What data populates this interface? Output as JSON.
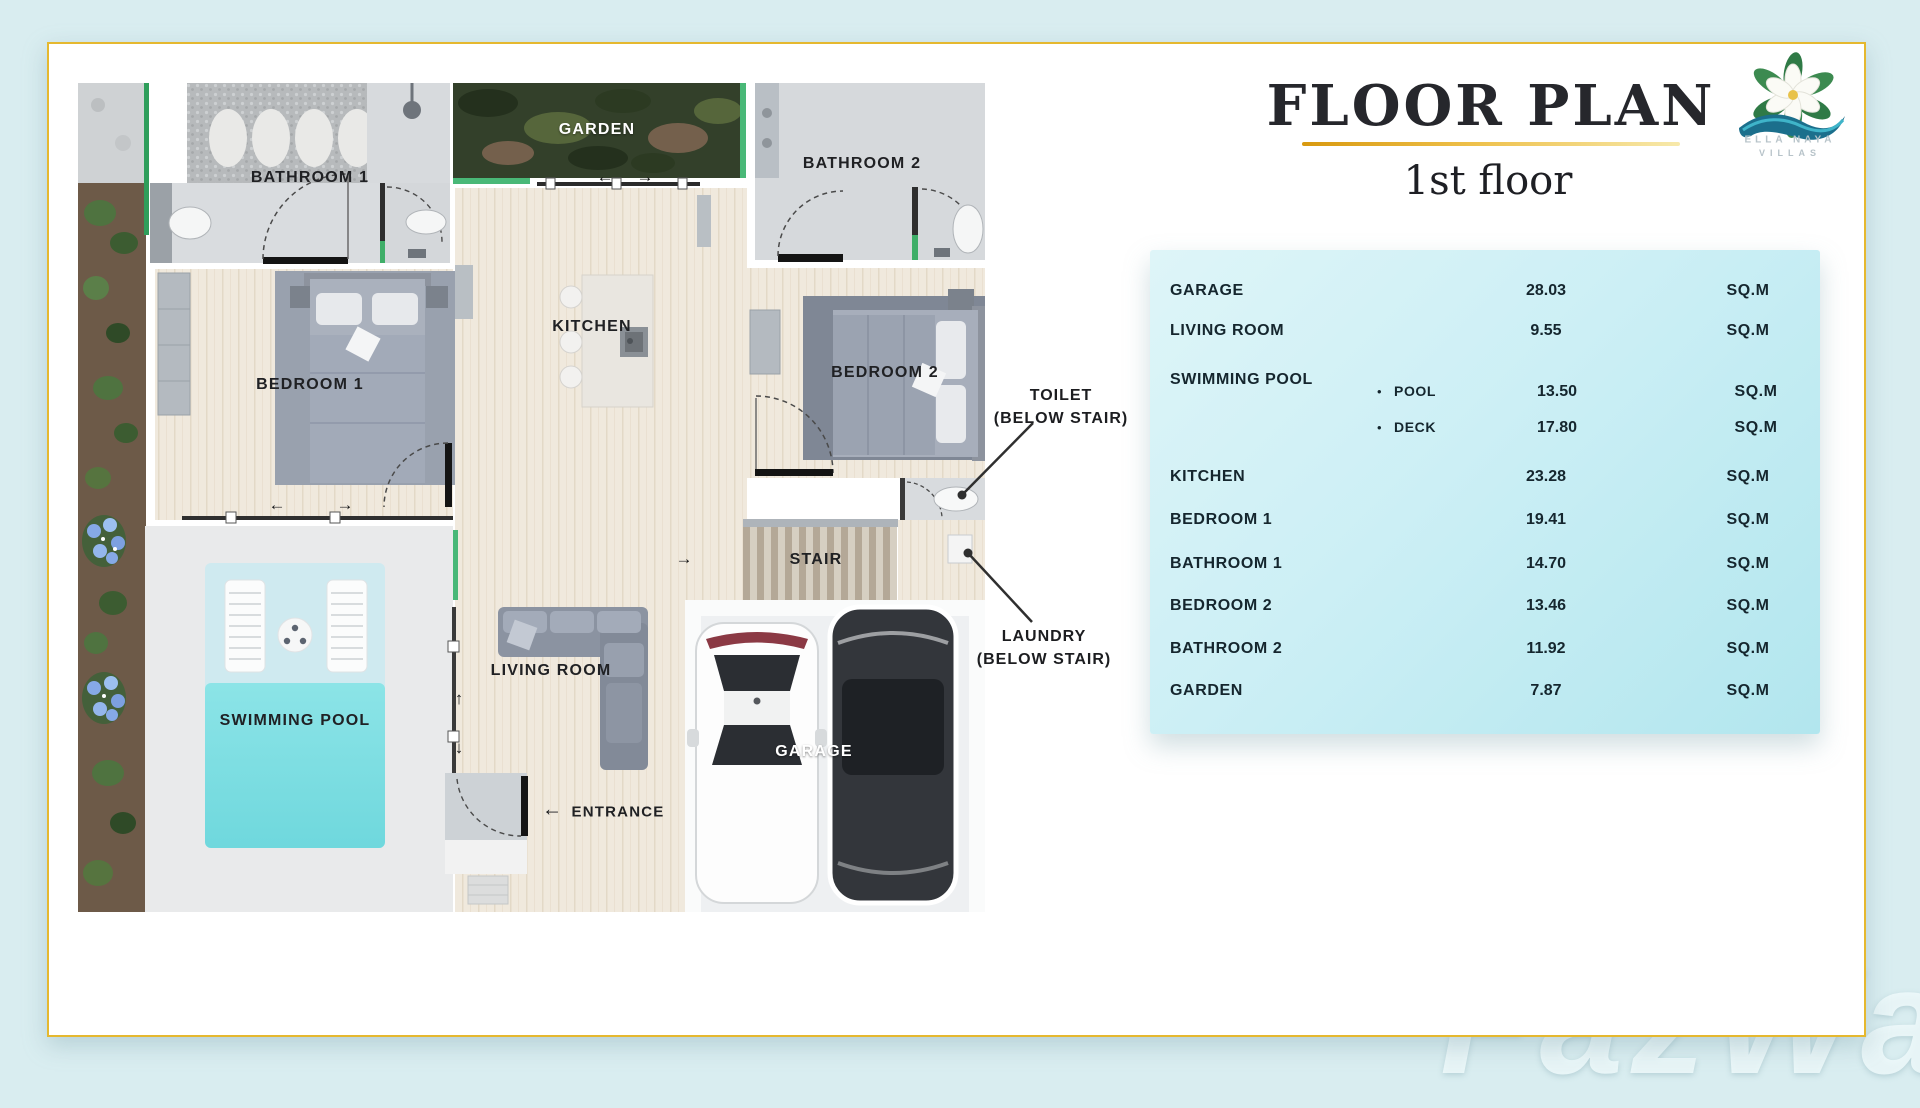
{
  "page": {
    "background": "#d9edf0",
    "watermark": "FazWaz"
  },
  "header": {
    "title": "FLOOR PLAN",
    "subtitle": "1st floor",
    "accent_color": "#E5B82F"
  },
  "logo": {
    "name_line1": "ELLA NAYA",
    "name_line2": "VILLAS"
  },
  "plan": {
    "room_labels": {
      "bathroom1": "BATHROOM 1",
      "garden": "GARDEN",
      "bathroom2": "BATHROOM 2",
      "kitchen": "KITCHEN",
      "bedroom1": "BEDROOM 1",
      "bedroom2": "BEDROOM 2",
      "stair": "STAIR",
      "swimming_pool": "SWIMMING POOL",
      "living_room": "LIVING ROOM",
      "garage": "GARAGE",
      "entrance": "ENTRANCE"
    },
    "annotations": {
      "toilet_line1": "TOILET",
      "toilet_line2": "(BELOW STAIR)",
      "laundry_line1": "LAUNDRY",
      "laundry_line2": "(BELOW STAIR)"
    },
    "arrows": {
      "left": "←",
      "right": "→",
      "up": "↑",
      "down": "↓"
    }
  },
  "area_table": {
    "unit": "SQ.M",
    "bullet": "•",
    "rows": [
      {
        "name": "GARAGE",
        "value": "28.03"
      },
      {
        "name": "LIVING ROOM",
        "value": "9.55"
      },
      {
        "name": "SWIMMING POOL",
        "value": "",
        "sub": [
          {
            "name": "POOL",
            "value": "13.50"
          },
          {
            "name": "DECK",
            "value": "17.80"
          }
        ]
      },
      {
        "name": "KITCHEN",
        "value": "23.28"
      },
      {
        "name": "BEDROOM 1",
        "value": "19.41"
      },
      {
        "name": "BATHROOM 1",
        "value": "14.70"
      },
      {
        "name": "BEDROOM 2",
        "value": "13.46"
      },
      {
        "name": "BATHROOM 2",
        "value": "11.92"
      },
      {
        "name": "GARDEN",
        "value": "7.87"
      }
    ]
  },
  "colors": {
    "pool_water": "#7FDFE3",
    "pool_deck": "#CFEAF0",
    "garden_green": "#33402A",
    "trim_green": "#49B877",
    "table_bg": "#C6EDF3",
    "gold_border": "#E5B82F"
  }
}
